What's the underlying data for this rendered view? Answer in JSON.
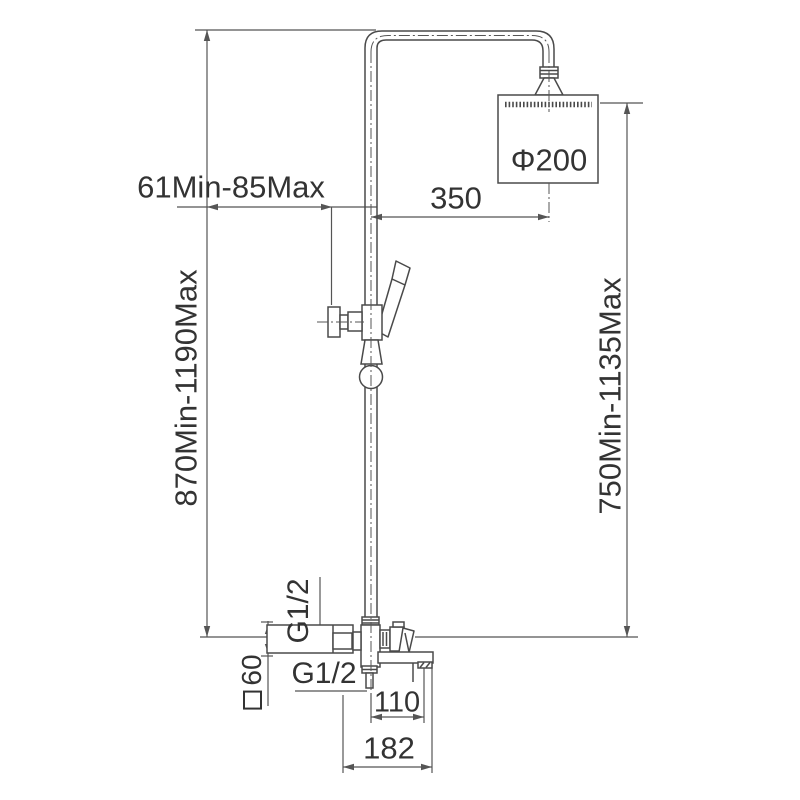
{
  "drawing": {
    "kind": "installation-dimension-diagram",
    "colors": {
      "line": "#4a4a4a",
      "dimension_line": "#555555",
      "text": "#333333",
      "background": "#ffffff"
    },
    "labels": {
      "wall_offset": "61Min-85Max",
      "arm_reach": "350",
      "head_diameter": "Φ200",
      "overall_height": "870Min-1190Max",
      "head_height": "750Min-1135Max",
      "thread_upper": "G1/2",
      "thread_lower": "G1/2",
      "body_square": "60",
      "outlet_spacing": "110",
      "body_width": "182"
    }
  }
}
